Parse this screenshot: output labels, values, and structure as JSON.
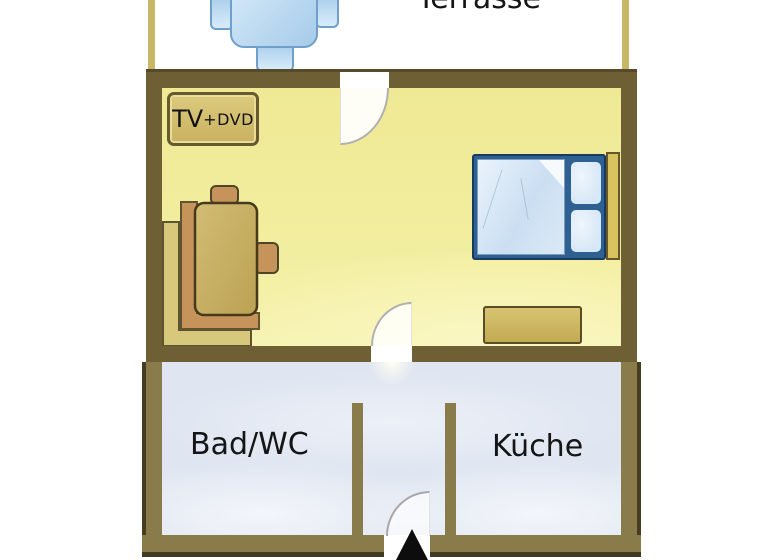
{
  "title": "Apartment floor plan",
  "labels": {
    "terrace": "Terrasse",
    "tv_main": "TV",
    "tv_suffix": "+DVD",
    "bath": "Bad/WC",
    "kitchen": "Küche"
  },
  "colors": {
    "background": "#ffffff",
    "wall_main": "#6e5f35",
    "wall_lower": "#8a7b4b",
    "wall_outer_edge": "#3f3a22",
    "terrace_fence": "#c9b768",
    "main_room_floor": "#f2ee9f",
    "lower_rooms_floor": "#dfe5f1",
    "furniture_wood": "#c9b267",
    "furniture_wood_orange": "#c6945a",
    "furniture_bench_light": "#d8c87c",
    "bed_frame_blue": "#2e6191",
    "bed_linen_blue": "#cbdff2",
    "terrace_table_blue": "#a9cdea",
    "door_arc_gray": "#b0b0b0",
    "entrance_arrow_black": "#0d0d0d",
    "label_text": "#151515"
  },
  "furniture_icons": {
    "terrace_table": "table-with-chairs-icon",
    "tv_cabinet": "tv-dvd-cabinet-icon",
    "seating": "corner-bench-sofa-with-table-icon",
    "bed": "double-bed-with-pillows-icon",
    "dresser": "dresser-icon",
    "entrance": "entrance-arrow-icon"
  }
}
